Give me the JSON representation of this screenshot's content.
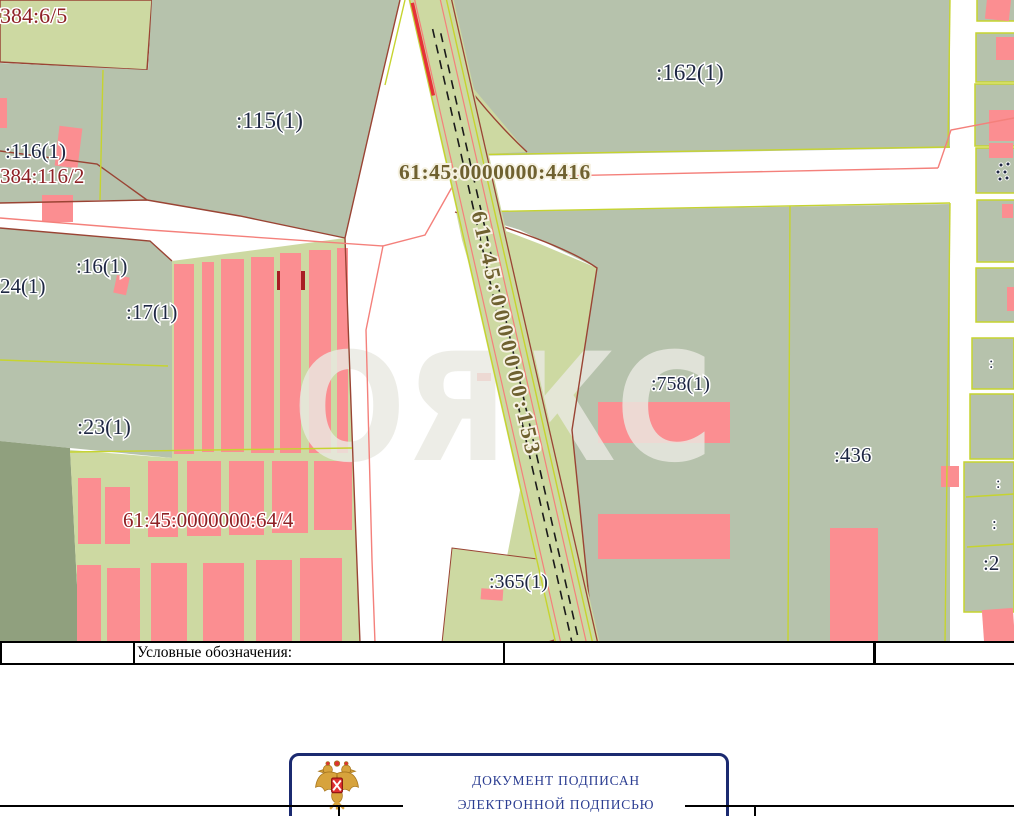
{
  "map": {
    "watermark_text": "ОЯКС",
    "labels": {
      "p384_6_5": "384:6/5",
      "p115": ":115(1)",
      "p116": ":116(1)",
      "p384_116_2": "384:116/2",
      "p162": ":162(1)",
      "p4416": "61:45:0000000:4416",
      "p153": "61:45:0000000:153",
      "p24": "24(1)",
      "p16": ":16(1)",
      "p17": ":17(1)",
      "p23": ":23(1)",
      "p64_4": "61:45:0000000:64/4",
      "p758": ":758(1)",
      "p436": ":436",
      "p365": ":365(1)",
      "edge_frag_1": ":",
      "edge_frag_2": ":",
      "edge_frag_3": ":",
      "edge_frag_4": ":2"
    },
    "colors": {
      "parcel_gray_green": "#b6c2ac",
      "parcel_light_green": "#cdd9a2",
      "parcel_dark_olive": "#90a07e",
      "building_pink": "#fb8e91",
      "building_dark_red": "#a81d23",
      "boundary_yellow_green": "#c6d42f",
      "boundary_brown": "#9a4434",
      "boundary_pink": "#f4807b",
      "railway_black": "#1a1a1a",
      "road_red": "#e63238",
      "label_navy": "#1e2743",
      "label_dark_red": "#8e2125",
      "label_olive": "#6f6130"
    }
  },
  "legend": {
    "title": "Условные обозначения:"
  },
  "stamp": {
    "line1": "ДОКУМЕНТ ПОДПИСАН",
    "line2": "ЭЛЕКТРОННОЙ ПОДПИСЬЮ",
    "border_color": "#1b2a70",
    "text_color": "#2c3e92"
  }
}
